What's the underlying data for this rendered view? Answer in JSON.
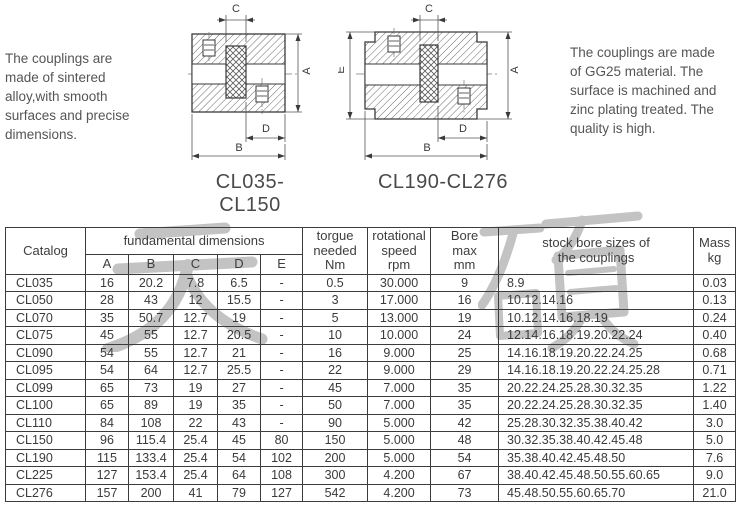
{
  "notes": {
    "left": "The couplings are\nmade of sintered\nalloy,with smooth\nsurfaces and precise\ndimensions.",
    "right": "The couplings are made\nof GG25 material. The\nsurface is machined and\nzinc plating treated. The\nquality is high."
  },
  "watermark": {
    "text": "天硕",
    "color": "#c3c3c3"
  },
  "drawings": {
    "left": {
      "caption": "CL035-CL150",
      "dim_c": "C",
      "dim_a": "A",
      "dim_b": "B",
      "dim_d": "D"
    },
    "right": {
      "caption": "CL190-CL276",
      "dim_c": "C",
      "dim_e": "E",
      "dim_a": "A",
      "dim_b": "B",
      "dim_d": "D"
    }
  },
  "table": {
    "header": {
      "catalog": "Catalog",
      "fundamental": "fundamental dimensions",
      "dims": [
        "A",
        "B",
        "C",
        "D",
        "E"
      ],
      "torque": "torgue\nneeded\nNm",
      "speed": "rotational\nspeed\nrpm",
      "bore": "Bore\nmax\nmm",
      "stock": "stock bore sizes of\nthe couplings",
      "mass": "Mass\nkg"
    },
    "rows": [
      {
        "catalog": "CL035",
        "a": "16",
        "b": "20.2",
        "c": "7.8",
        "d": "6.5",
        "e": "-",
        "torque": "0.5",
        "speed": "30.000",
        "bore": "9",
        "stock": "8.9",
        "mass": "0.03"
      },
      {
        "catalog": "CL050",
        "a": "28",
        "b": "43",
        "c": "12",
        "d": "15.5",
        "e": "-",
        "torque": "3",
        "speed": "17.000",
        "bore": "16",
        "stock": "10.12.14.16",
        "mass": "0.13"
      },
      {
        "catalog": "CL070",
        "a": "35",
        "b": "50.7",
        "c": "12.7",
        "d": "19",
        "e": "-",
        "torque": "5",
        "speed": "13.000",
        "bore": "19",
        "stock": "10.12.14.16.18.19",
        "mass": "0.24"
      },
      {
        "catalog": "CL075",
        "a": "45",
        "b": "55",
        "c": "12.7",
        "d": "20.5",
        "e": "-",
        "torque": "10",
        "speed": "10.000",
        "bore": "24",
        "stock": "12.14.16.18.19.20.22.24",
        "mass": "0.40"
      },
      {
        "catalog": "CL090",
        "a": "54",
        "b": "55",
        "c": "12.7",
        "d": "21",
        "e": "-",
        "torque": "16",
        "speed": "9.000",
        "bore": "25",
        "stock": "14.16.18.19.20.22.24.25",
        "mass": "0.68"
      },
      {
        "catalog": "CL095",
        "a": "54",
        "b": "64",
        "c": "12.7",
        "d": "25.5",
        "e": "-",
        "torque": "22",
        "speed": "9.000",
        "bore": "29",
        "stock": "14.16.18.19.20.22.24.25.28",
        "mass": "0.71"
      },
      {
        "catalog": "CL099",
        "a": "65",
        "b": "73",
        "c": "19",
        "d": "27",
        "e": "-",
        "torque": "45",
        "speed": "7.000",
        "bore": "35",
        "stock": "20.22.24.25.28.30.32.35",
        "mass": "1.22"
      },
      {
        "catalog": "CL100",
        "a": "65",
        "b": "89",
        "c": "19",
        "d": "35",
        "e": "-",
        "torque": "50",
        "speed": "7.000",
        "bore": "35",
        "stock": "20.22.24.25.28.30.32.35",
        "mass": "1.40"
      },
      {
        "catalog": "CL110",
        "a": "84",
        "b": "108",
        "c": "22",
        "d": "43",
        "e": "-",
        "torque": "90",
        "speed": "5.000",
        "bore": "42",
        "stock": "25.28.30.32.35.38.40.42",
        "mass": "3.0"
      },
      {
        "catalog": "CL150",
        "a": "96",
        "b": "115.4",
        "c": "25.4",
        "d": "45",
        "e": "80",
        "torque": "150",
        "speed": "5.000",
        "bore": "48",
        "stock": "30.32.35.38.40.42.45.48",
        "mass": "5.0"
      },
      {
        "catalog": "CL190",
        "a": "115",
        "b": "133.4",
        "c": "25.4",
        "d": "54",
        "e": "102",
        "torque": "200",
        "speed": "5.000",
        "bore": "54",
        "stock": "35.38.40.42.45.48.50",
        "mass": "7.6"
      },
      {
        "catalog": "CL225",
        "a": "127",
        "b": "153.4",
        "c": "25.4",
        "d": "64",
        "e": "108",
        "torque": "300",
        "speed": "4.200",
        "bore": "67",
        "stock": "38.40.42.45.48.50.55.60.65",
        "mass": "9.0"
      },
      {
        "catalog": "CL276",
        "a": "157",
        "b": "200",
        "c": "41",
        "d": "79",
        "e": "127",
        "torque": "542",
        "speed": "4.200",
        "bore": "73",
        "stock": "45.48.50.55.60.65.70",
        "mass": "21.0"
      }
    ]
  }
}
